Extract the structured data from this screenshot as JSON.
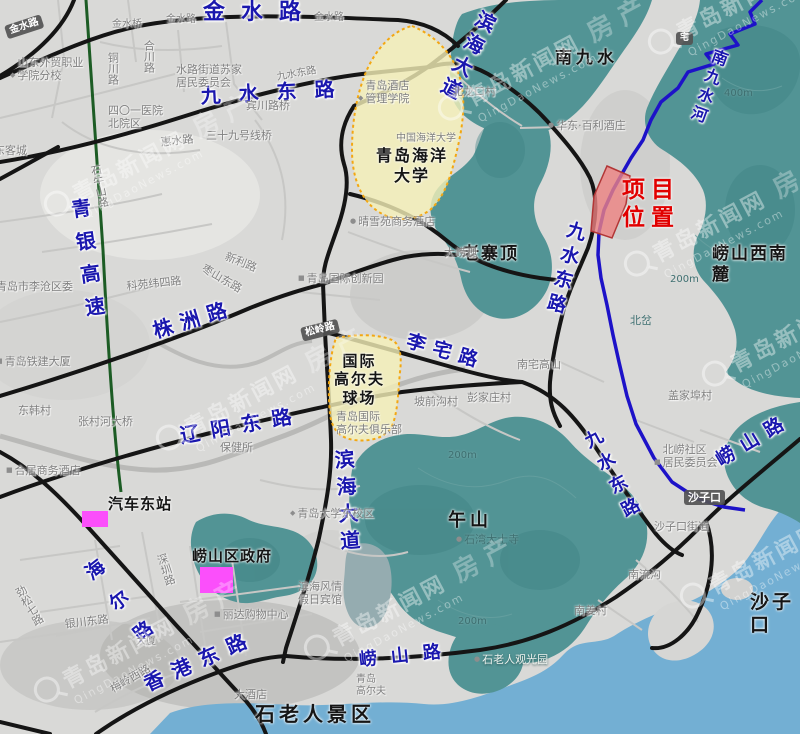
{
  "meta": {
    "watermark_text": "青岛新闻网",
    "watermark_estate": "房产",
    "watermark_url": "QingDaoNews.com",
    "project_color": "#e10000",
    "road_label_color": "#1a17ae",
    "mountain_color": "#529495",
    "sea_color": "#73afd3",
    "highlight_area_color": "#f2edb8",
    "project_parcel_color": "#ee8282",
    "marker_color": "#fb4ffb"
  },
  "map": {
    "labels": [
      {
        "n": "road-label-jinshui-lu",
        "t": "金水路",
        "x": 203,
        "y": 0,
        "c": "blue",
        "s": 22,
        "ls": 16
      },
      {
        "n": "road-label-jiushui-donglu-top",
        "t": "九水东路",
        "x": 200,
        "y": 84,
        "c": "blue",
        "s": 20,
        "ls": 18,
        "r": -3
      },
      {
        "n": "road-label-binhai-dadao-top",
        "t": "滨海大道",
        "x": 478,
        "y": 6,
        "c": "blue",
        "s": 20,
        "ls": 5,
        "v": 1,
        "r": 27
      },
      {
        "n": "road-label-qingyin-gaosu",
        "t": "青银高速",
        "x": 66,
        "y": 200,
        "c": "blue",
        "s": 20,
        "ls": 13,
        "v": 1,
        "r": -8
      },
      {
        "n": "road-label-zhuzhou-lu",
        "t": "株洲路",
        "x": 150,
        "y": 320,
        "c": "blue",
        "s": 20,
        "ls": 8,
        "r": -17
      },
      {
        "n": "road-label-liaoyang-donglu",
        "t": "辽阳东路",
        "x": 178,
        "y": 424,
        "c": "blue",
        "s": 20,
        "ls": 11,
        "r": -10
      },
      {
        "n": "road-label-lizhai-lu",
        "t": "李宅路",
        "x": 410,
        "y": 330,
        "c": "blue",
        "s": 19,
        "ls": 8,
        "r": 16
      },
      {
        "n": "road-label-jiushui-donglu-mid",
        "t": "九水东路",
        "x": 566,
        "y": 218,
        "c": "blue",
        "s": 19,
        "ls": 6,
        "v": 1,
        "r": 15
      },
      {
        "n": "road-label-binhai-dadao-mid",
        "t": "滨海大道",
        "x": 330,
        "y": 450,
        "c": "blue",
        "s": 20,
        "ls": 7,
        "v": 1,
        "r": -4
      },
      {
        "n": "road-label-haier-lu",
        "t": "海尔路",
        "x": 78,
        "y": 570,
        "c": "blue",
        "s": 19,
        "ls": 20,
        "v": 1,
        "r": -38
      },
      {
        "n": "road-label-jiushui-donglu-low",
        "t": "九水东路",
        "x": 578,
        "y": 436,
        "c": "blue",
        "s": 18,
        "ls": 8,
        "v": 1,
        "r": -28
      },
      {
        "n": "road-label-laoshan-lu-right",
        "t": "崂山路",
        "x": 712,
        "y": 452,
        "c": "blue",
        "s": 19,
        "ls": 9,
        "r": -31
      },
      {
        "n": "road-label-laoshan-lu-bottom",
        "t": "崂山路",
        "x": 358,
        "y": 650,
        "c": "blue",
        "s": 18,
        "ls": 14,
        "r": -6
      },
      {
        "n": "road-label-xianggang-donglu",
        "t": "香港东路",
        "x": 140,
        "y": 674,
        "c": "blue",
        "s": 20,
        "ls": 10,
        "r": -24
      },
      {
        "n": "river-label-nanjiushui-he",
        "t": "南九水河",
        "x": 712,
        "y": 46,
        "c": "blue",
        "s": 16,
        "ls": 4,
        "v": 1,
        "r": 20
      },
      {
        "n": "place-label-nanjiushui",
        "t": "南九水",
        "x": 555,
        "y": 48,
        "c": "black",
        "s": 17,
        "ls": 4
      },
      {
        "n": "place-label-laozhaiding",
        "t": "老寨顶",
        "x": 462,
        "y": 244,
        "c": "black",
        "s": 17,
        "ls": 2
      },
      {
        "n": "place-label-laoshan-xinanlu",
        "t": "崂山西南麓",
        "x": 712,
        "y": 244,
        "c": "black",
        "s": 17,
        "ls": 2
      },
      {
        "n": "place-label-wushan",
        "t": "午山",
        "x": 448,
        "y": 510,
        "c": "black",
        "s": 18,
        "ls": 4
      },
      {
        "n": "place-label-shilaoren-jingqu",
        "t": "石老人景区",
        "x": 255,
        "y": 702,
        "c": "black",
        "s": 20,
        "ls": 4
      },
      {
        "n": "place-label-shazikou-big",
        "t": "沙子口",
        "x": 750,
        "y": 591,
        "c": "black",
        "s": 19,
        "ls": 3
      },
      {
        "n": "poi-label-qiche-dongzhan",
        "t": "汽车东站",
        "x": 108,
        "y": 495,
        "c": "black",
        "s": 15,
        "ls": 1
      },
      {
        "n": "poi-label-laoshanqu-zhengfu",
        "t": "崂山区政府",
        "x": 192,
        "y": 547,
        "c": "black",
        "s": 15,
        "ls": 1
      },
      {
        "n": "area-label-ocean-university",
        "t": "青岛海洋\n大学",
        "x": 376,
        "y": 146,
        "c": "black",
        "s": 16,
        "ls": 2,
        "ctr": 1
      },
      {
        "n": "area-label-golf-course",
        "t": "国际\n高尔夫\n球场",
        "x": 334,
        "y": 352,
        "c": "black",
        "s": 15,
        "ls": 2,
        "ctr": 1
      },
      {
        "n": "project-location-label",
        "t": "项目\n位置",
        "x": 622,
        "y": 176,
        "c": "red",
        "s": 23,
        "ls": 6,
        "ctr": 1
      },
      {
        "n": "poi-label-waimao-xueyuan",
        "t": "山东外贸职业\n学院分校",
        "x": 10,
        "y": 56,
        "c": "gray",
        "icon": "school"
      },
      {
        "n": "road-label-tongchuan-lu",
        "t": "铜川路",
        "x": 106,
        "y": 52,
        "c": "gray",
        "v": 1
      },
      {
        "n": "road-label-hechuan-lu",
        "t": "合川路",
        "x": 142,
        "y": 40,
        "c": "gray",
        "v": 1
      },
      {
        "n": "poi-label-shuilu-juweihui",
        "t": "水路街道苏家\n居民委员会",
        "x": 176,
        "y": 63,
        "c": "gray"
      },
      {
        "n": "road-label-jinshui-small-1",
        "t": "金水路",
        "x": 166,
        "y": 14,
        "c": "gray",
        "s": 10
      },
      {
        "n": "road-label-jinshui-small-2",
        "t": "金水路",
        "x": 314,
        "y": 12,
        "c": "gray",
        "s": 10
      },
      {
        "n": "poi-label-jinshui-qiao",
        "t": "金水桥",
        "x": 112,
        "y": 19,
        "c": "gray",
        "s": 10
      },
      {
        "n": "road-badge-jinshui",
        "t": "金水路",
        "x": 4,
        "y": 26,
        "c": "badge",
        "s": 10,
        "r": -18
      },
      {
        "n": "road-label-jiushui-small",
        "t": "九水东路",
        "x": 276,
        "y": 72,
        "c": "gray",
        "s": 10,
        "r": -10
      },
      {
        "n": "poi-label-jiudian-guanli-xueyuan",
        "t": "青岛酒店\n管理学院",
        "x": 358,
        "y": 79,
        "c": "gray",
        "icon": "school"
      },
      {
        "n": "poi-label-401-hospital",
        "t": "四〇一医院\n北院区",
        "x": 108,
        "y": 104,
        "c": "gray"
      },
      {
        "n": "road-label-huishui-lu",
        "t": "惠水路",
        "x": 160,
        "y": 136,
        "c": "gray",
        "r": -6
      },
      {
        "n": "poi-label-39-xianqiao",
        "t": "三十九号线桥",
        "x": 206,
        "y": 129,
        "c": "gray"
      },
      {
        "n": "poi-label-binchuan-luqiao",
        "t": "宾川路桥",
        "x": 246,
        "y": 99,
        "c": "gray"
      },
      {
        "n": "place-label-beilongkou-cun",
        "t": "北龙口村",
        "x": 452,
        "y": 85,
        "c": "gray"
      },
      {
        "n": "poi-label-huadong-baili",
        "t": "华东·百利酒庄",
        "x": 548,
        "y": 119,
        "c": "gray",
        "icon": "dot"
      },
      {
        "n": "road-label-shiniushan-lu",
        "t": "石牛山路",
        "x": 88,
        "y": 166,
        "c": "gray",
        "v": 1,
        "r": -12
      },
      {
        "n": "place-label-dongkecheng",
        "t": "东客城",
        "x": -6,
        "y": 144,
        "c": "gray"
      },
      {
        "n": "poi-label-licangquwei",
        "t": "青岛市李沧区委",
        "x": -4,
        "y": 280,
        "c": "gray"
      },
      {
        "n": "road-label-xinli-lu",
        "t": "新利路",
        "x": 228,
        "y": 250,
        "c": "gray",
        "r": 22
      },
      {
        "n": "road-label-zaoshan-donglu",
        "t": "枣山东路",
        "x": 206,
        "y": 262,
        "c": "gray",
        "r": 30
      },
      {
        "n": "road-label-keyuan-weisilu",
        "t": "科苑纬四路",
        "x": 126,
        "y": 280,
        "c": "gray",
        "r": -6
      },
      {
        "n": "poi-label-chuangxinyuan",
        "t": "青岛国际创新园",
        "x": 298,
        "y": 272,
        "c": "gray",
        "icon": "sq"
      },
      {
        "n": "road-badge-songling-lu",
        "t": "松岭路",
        "x": 300,
        "y": 328,
        "c": "badge",
        "s": 10,
        "r": -14
      },
      {
        "n": "poi-label-tiejian-dasha",
        "t": "青岛铁建大厦",
        "x": -4,
        "y": 355,
        "c": "gray",
        "icon": "sq"
      },
      {
        "n": "place-label-donghan-cun",
        "t": "东韩村",
        "x": 18,
        "y": 404,
        "c": "gray"
      },
      {
        "n": "poi-label-zhangcunhe-daqiao",
        "t": "张村河大桥",
        "x": 78,
        "y": 415,
        "c": "gray"
      },
      {
        "n": "poi-label-heju-hotel",
        "t": "合居商务酒店",
        "x": 6,
        "y": 464,
        "c": "gray",
        "icon": "sq"
      },
      {
        "n": "poi-label-baojiansuo",
        "t": "保健所",
        "x": 220,
        "y": 441,
        "c": "gray"
      },
      {
        "n": "poi-label-qingxueyuan-hotel",
        "t": "晴雪苑商务酒店",
        "x": 350,
        "y": 215,
        "c": "gray",
        "icon": "dot"
      },
      {
        "n": "poi-label-ocean-univ-gray",
        "t": "中国海洋大学",
        "x": 396,
        "y": 133,
        "c": "gray",
        "s": 10
      },
      {
        "n": "place-label-dalaoguang",
        "t": "大崂观",
        "x": 444,
        "y": 246,
        "c": "gray"
      },
      {
        "n": "place-label-nanzhai-gaoshan",
        "t": "南宅高山",
        "x": 517,
        "y": 358,
        "c": "gray"
      },
      {
        "n": "place-label-pengjiazhuang",
        "t": "彭家庄村",
        "x": 467,
        "y": 391,
        "c": "gray"
      },
      {
        "n": "place-label-gaijiabu",
        "t": "盖家埠村",
        "x": 668,
        "y": 389,
        "c": "gray"
      },
      {
        "n": "place-label-poqiangou",
        "t": "坡前沟村",
        "x": 414,
        "y": 395,
        "c": "gray"
      },
      {
        "n": "poi-label-golf-club",
        "t": "青岛国际\n高尔夫俱乐部",
        "x": 336,
        "y": 410,
        "c": "gray"
      },
      {
        "n": "poi-label-beilao-shequ",
        "t": "北崂社区\n居民委员会",
        "x": 654,
        "y": 443,
        "c": "gray",
        "icon": "sq"
      },
      {
        "n": "place-label-shazikou-jiedao",
        "t": "沙子口街道",
        "x": 654,
        "y": 520,
        "c": "gray"
      },
      {
        "n": "place-label-nanliugou",
        "t": "南流沟",
        "x": 628,
        "y": 568,
        "c": "gray"
      },
      {
        "n": "place-label-nanjiang-cun",
        "t": "南姜村",
        "x": 574,
        "y": 604,
        "c": "gray"
      },
      {
        "n": "poi-label-shiwan-dashisi",
        "t": "石湾大士寺",
        "x": 456,
        "y": 533,
        "c": "tealdark",
        "icon": "dot"
      },
      {
        "n": "poi-label-shilaoren-guanguangyuan",
        "t": "石老人观光园",
        "x": 474,
        "y": 653,
        "c": "whiteteal",
        "icon": "dot"
      },
      {
        "n": "poi-label-qingdao-univ-east",
        "t": "青岛大学东校区",
        "x": 290,
        "y": 507,
        "c": "gray",
        "icon": "school"
      },
      {
        "n": "poi-label-lida-shopping",
        "t": "丽达购物中心",
        "x": 214,
        "y": 608,
        "c": "gray",
        "icon": "sq"
      },
      {
        "n": "poi-label-binhai-fengqing",
        "t": "滨海风情\n假日宾馆",
        "x": 298,
        "y": 580,
        "c": "gray"
      },
      {
        "n": "road-label-yinchuan-donglu",
        "t": "银川东路",
        "x": 64,
        "y": 618,
        "c": "gray",
        "r": -7
      },
      {
        "n": "road-label-shenzhen-lu",
        "t": "深圳路",
        "x": 154,
        "y": 556,
        "c": "gray",
        "v": 1,
        "r": -18
      },
      {
        "n": "road-label-jinsong-qilu",
        "t": "劲松七路",
        "x": 12,
        "y": 590,
        "c": "gray",
        "v": 1,
        "r": -30
      },
      {
        "n": "road-label-meiling-xilu",
        "t": "梅岭西路",
        "x": 108,
        "y": 684,
        "c": "gray",
        "r": -30
      },
      {
        "n": "poi-label-dajiudian",
        "t": "大酒店",
        "x": 234,
        "y": 688,
        "c": "gray"
      },
      {
        "n": "poi-label-qingdao-golf",
        "t": "青岛\n高尔夫",
        "x": 356,
        "y": 674,
        "c": "gray",
        "s": 10
      },
      {
        "n": "place-label-beicha",
        "t": "北岔",
        "x": 630,
        "y": 314,
        "c": "tealdark"
      },
      {
        "n": "contour-label-400m",
        "t": "400m",
        "x": 724,
        "y": 88,
        "c": "tealdark",
        "s": 10
      },
      {
        "n": "contour-label-200m-a",
        "t": "200m",
        "x": 670,
        "y": 274,
        "c": "tealdark",
        "s": 10
      },
      {
        "n": "contour-label-200m-b",
        "t": "200m",
        "x": 448,
        "y": 450,
        "c": "tealdark",
        "s": 10
      },
      {
        "n": "contour-label-200m-c",
        "t": "200m",
        "x": 458,
        "y": 616,
        "c": "tealdark",
        "s": 10
      },
      {
        "n": "badge-zhai",
        "t": "宅",
        "x": 676,
        "y": 32,
        "c": "badge",
        "s": 9
      },
      {
        "n": "poi-label-dasha",
        "t": "大厦",
        "x": 136,
        "y": 636,
        "c": "gray",
        "s": 10
      },
      {
        "n": "badge-shazikou",
        "t": "沙子口",
        "x": 684,
        "y": 490,
        "c": "badge",
        "s": 11
      }
    ]
  },
  "watermarks": [
    {
      "x": 640,
      "y": 30
    },
    {
      "x": 430,
      "y": 96
    },
    {
      "x": 36,
      "y": 192
    },
    {
      "x": 616,
      "y": 252
    },
    {
      "x": 148,
      "y": 426
    },
    {
      "x": 694,
      "y": 362
    },
    {
      "x": 296,
      "y": 636
    },
    {
      "x": 672,
      "y": 584
    },
    {
      "x": 26,
      "y": 678
    }
  ]
}
